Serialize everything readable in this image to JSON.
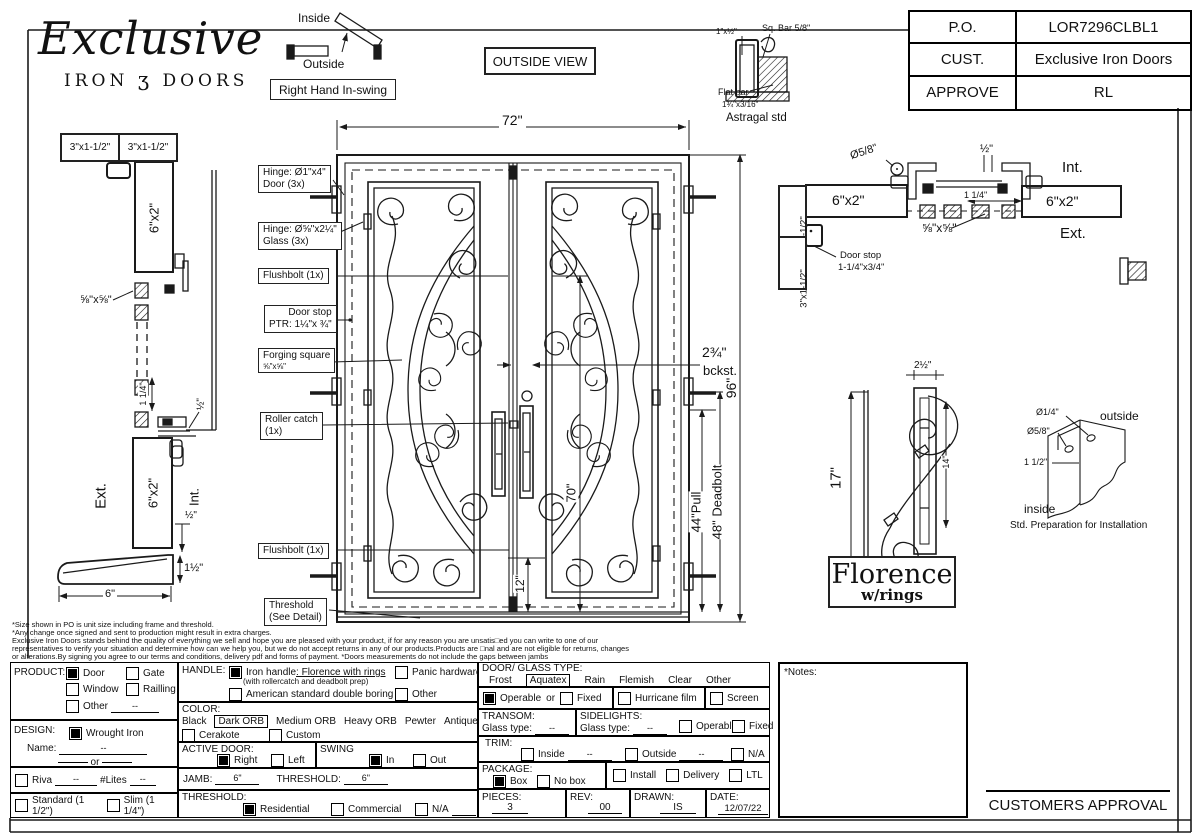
{
  "logo": {
    "script": "Exclusive",
    "iron": "IRON",
    "glyph": "ʒ",
    "doors": "DOORS"
  },
  "swing": {
    "inside": "Inside",
    "outside": "Outside",
    "label": "Right Hand In-swing"
  },
  "outside_view": "OUTSIDE VIEW",
  "astragal": {
    "tube": "1\"x½\"",
    "sq_bar": "Sq. Bar 5/8\"",
    "flat": "Flat bar",
    "flat_size": "1¾\"x3/16\"",
    "caption": "Astragal std"
  },
  "title_block": {
    "r1l": "P.O.",
    "r1v": "LOR7296CLBL1",
    "r2l": "CUST.",
    "r2v": "Exclusive Iron Doors",
    "r3l": "APPROVE",
    "r3v": "RL"
  },
  "left_section": {
    "jamb1": "3\"x1-1/2\"",
    "jamb2": "3\"x1-1/2\"",
    "tube_top": "6\"x2\"",
    "forging": "⅝\"x⅝\"",
    "dim114": "1 1/4\"",
    "half_top": "½\"",
    "ext": "Ext.",
    "tube_bot": "6\"x2\"",
    "int": "Int.",
    "half": "½\"",
    "width": "6\"",
    "height": "1½\""
  },
  "door": {
    "dims": {
      "w": "72\"",
      "h": "96\"",
      "glass": "70\"",
      "bottom": "12\"",
      "backset": "2¾\"",
      "backset_sub": "bckst.",
      "pull": "44\"Pull",
      "deadbolt": "48\" Deadbolt"
    },
    "callouts": {
      "c1a": "Hinge: Ø1\"x4\"",
      "c1b": "Door (3x)",
      "c2a": "Hinge: Ø⅝\"x2¼\"",
      "c2b": "Glass (3x)",
      "c3": "Flushbolt (1x)",
      "c4a": "Door stop",
      "c4b": "PTR: 1¼\"x ¾\"",
      "c5a": "Forging square",
      "c5b": "⅝\"x⅝\"",
      "c6a": "Roller catch",
      "c6b": "(1x)",
      "c7": "Flushbolt (1x)",
      "c8a": "Threshold",
      "c8b": "(See Detail)"
    }
  },
  "right_section": {
    "jamb1": "3\"x1-1/2\"",
    "jamb2": "3\"x1-1/2\"",
    "tube_l": "6\"x2\"",
    "tube_r": "6\"x2\"",
    "dia": "Ø5/8\"",
    "half": "½\"",
    "dim114": "1 1/4\"",
    "int": "Int.",
    "ext": "Ext.",
    "forging": "⅝\"x⅝\"",
    "stop1": "Door stop",
    "stop2": "1-1/4\"x3/4\""
  },
  "handle_detail": {
    "height": "17\"",
    "width": "2½\"",
    "inner": "14\"",
    "name1": "Florence",
    "name2": "w/rings"
  },
  "prep": {
    "d1": "Ø1/4\"",
    "d2": "Ø5/8\"",
    "d3": "1 1/2\"",
    "outside": "outside",
    "inside": "inside",
    "caption": "Std. Preparation for Installation"
  },
  "disclaimer": {
    "l1": "*Size shown in PO is unit size including frame and threshold.",
    "l2": "*Any change once signed and sent to production might result in extra charges.",
    "l3": "Exclusive Iron Doors stands behind the quality of everything we sell and hope you are pleased with your product, if for any reason you are unsatis□ed you can write to one of our",
    "l4": "representatives to verify your situation and determine how can we help you, but we do not accept returns in any of our products.Products are □nal and are not eligible for returns, changes",
    "l5": "or alterations.By signing you agree to our terms and conditions, delivery pdf and forms of payment. *Doors measurements do not include the gaps between jambs"
  },
  "form": {
    "product": {
      "label": "PRODUCT:",
      "door": "Door",
      "gate": "Gate",
      "window": "Window",
      "railling": "Railling",
      "other": "Other",
      "other_val": "--"
    },
    "design": {
      "label": "DESIGN:",
      "wrought": "Wrought Iron",
      "name_label": "Name:",
      "name_val": "--",
      "or": "or"
    },
    "riva": {
      "label": "Riva",
      "val": "--",
      "lites": "#Lites",
      "lites_val": "--"
    },
    "thickness": {
      "standard": "Standard (1 1/2\")",
      "slim": "Slim (1 1/4\")"
    },
    "handle": {
      "label": "HANDLE:",
      "iron1": "Iron handle",
      "iron2": ": Florence with rings",
      "iron_sub": "(with rollercatch and deadbolt prep)",
      "panic": "Panic hardware",
      "american": "American standard double boring",
      "other": "Other"
    },
    "color": {
      "label": "COLOR:",
      "black": "Black",
      "dark": "Dark ORB",
      "medium": "Medium ORB",
      "heavy": "Heavy ORB",
      "pewter": "Pewter",
      "antique": "Antique gold",
      "cerakote": "Cerakote",
      "custom": "Custom"
    },
    "active": {
      "label": "ACTIVE DOOR:",
      "right": "Right",
      "left": "Left"
    },
    "swing": {
      "label": "SWING",
      "in": "In",
      "out": "Out"
    },
    "jamb": {
      "label": "JAMB:",
      "val": "6\"",
      "t_label": "THRESHOLD:",
      "t_val": "6\""
    },
    "threshold": {
      "label": "THRESHOLD:",
      "res": "Residential",
      "com": "Commercial",
      "na": "N/A"
    },
    "glass": {
      "label": "DOOR/ GLASS TYPE:",
      "frost": "Frost",
      "aquatex": "Aquatex",
      "rain": "Rain",
      "flemish": "Flemish",
      "clear": "Clear",
      "other": "Other"
    },
    "operable": {
      "op": "Operable",
      "or": "or",
      "fixed": "Fixed",
      "hurricane": "Hurricane film",
      "screen": "Screen"
    },
    "transom": {
      "label": "TRANSOM:",
      "glass_type": "Glass type:",
      "val": "--"
    },
    "sidelights": {
      "label": "SIDELIGHTS:",
      "glass_type": "Glass type:",
      "val": "--",
      "op": "Operable",
      "fixed": "Fixed"
    },
    "trim": {
      "label": "TRIM:",
      "inside": "Inside",
      "inside_val": "--",
      "outside": "Outside",
      "outside_val": "--",
      "na": "N/A"
    },
    "package": {
      "label": "PACKAGE:",
      "box": "Box",
      "nobox": "No box",
      "install": "Install",
      "delivery": "Delivery",
      "ltl": "LTL"
    },
    "meta": {
      "pieces_l": "PIECES:",
      "pieces": "3",
      "rev_l": "REV:",
      "rev": "00",
      "drawn_l": "DRAWN:",
      "drawn": "IS",
      "date_l": "DATE:",
      "date": "12/07/22"
    }
  },
  "notes_label": "*Notes:",
  "approval": "CUSTOMERS APPROVAL"
}
